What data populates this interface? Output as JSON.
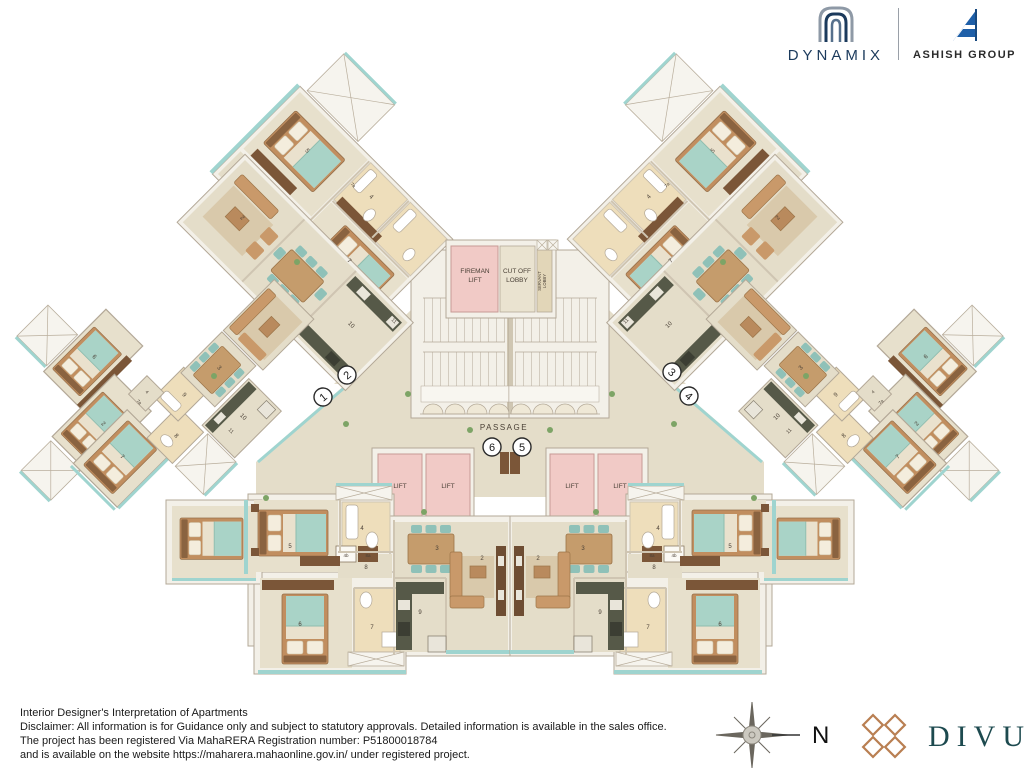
{
  "header": {
    "brand1": "DYNAMIX",
    "brand2": "ASHISH GROUP"
  },
  "footer": {
    "line1": "Interior Designer's Interpretation of Apartments",
    "line2": "Disclaimer: All information is for Guidance only and subject to statutory approvals. Detailed information is available in the sales office.",
    "line3": "The project has been registered Via MahaRERA Registration number:  P51800018784",
    "line4": "and is available on the website https://maharera.mahaonline.gov.in/ under registered project.",
    "compass_north": "N",
    "brand": "DIVUM"
  },
  "plan": {
    "colors": {
      "wall_line": "#b3a897",
      "floor": "#e4ddc9",
      "room_floor": "#e7e0cc",
      "bath_floor": "#eedebb",
      "lift_pink": "#f1cac6",
      "teal_edge": "#9fd4cf",
      "bed_blanket": "#a9d3c7",
      "wood": "#c59c6c",
      "dark_wood": "#6e4d33",
      "counter": "#565948",
      "navy": "#1b3a5c",
      "blue": "#1e5fa8",
      "copper": "#b97f52",
      "teal_dark": "#1d4a4f"
    },
    "labels": [
      {
        "t": "FIREMAN",
        "x": 475,
        "y": 273,
        "s": 6.5
      },
      {
        "t": "LIFT",
        "x": 475,
        "y": 282,
        "s": 6.5
      },
      {
        "t": "CUT OFF",
        "x": 517,
        "y": 273,
        "s": 6.5
      },
      {
        "t": "LOBBY",
        "x": 517,
        "y": 282,
        "s": 6.5
      },
      {
        "t": "SERVANT",
        "x": 541,
        "y": 281,
        "s": 4.2,
        "r": -90
      },
      {
        "t": "LOBBY",
        "x": 546,
        "y": 281,
        "s": 4.2,
        "r": -90
      },
      {
        "t": "PASSAGE",
        "x": 504,
        "y": 430,
        "s": 8,
        "ls": 1.5
      },
      {
        "t": "LIFT",
        "x": 400,
        "y": 488,
        "s": 6.5
      },
      {
        "t": "LIFT",
        "x": 448,
        "y": 488,
        "s": 6.5
      },
      {
        "t": "LIFT",
        "x": 572,
        "y": 488,
        "s": 6.5
      },
      {
        "t": "LIFT",
        "x": 620,
        "y": 488,
        "s": 6.5
      },
      {
        "t": "5",
        "x": 290,
        "y": 548,
        "s": 6
      },
      {
        "t": "4",
        "x": 362,
        "y": 530,
        "s": 6
      },
      {
        "t": "3",
        "x": 437,
        "y": 550,
        "s": 6
      },
      {
        "t": "8",
        "x": 366,
        "y": 569,
        "s": 6
      },
      {
        "t": "2",
        "x": 482,
        "y": 560,
        "s": 6
      },
      {
        "t": "6",
        "x": 300,
        "y": 626,
        "s": 6
      },
      {
        "t": "7",
        "x": 372,
        "y": 629,
        "s": 6
      },
      {
        "t": "9",
        "x": 420,
        "y": 614,
        "s": 6
      },
      {
        "t": "4b",
        "x": 346,
        "y": 557,
        "s": 4.5
      },
      {
        "t": "8a",
        "x": 368,
        "y": 557,
        "s": 4.5
      },
      {
        "t": "5",
        "x": 730,
        "y": 548,
        "s": 6
      },
      {
        "t": "4",
        "x": 658,
        "y": 530,
        "s": 6
      },
      {
        "t": "3",
        "x": 583,
        "y": 550,
        "s": 6
      },
      {
        "t": "8",
        "x": 654,
        "y": 569,
        "s": 6
      },
      {
        "t": "2",
        "x": 538,
        "y": 560,
        "s": 6
      },
      {
        "t": "6",
        "x": 720,
        "y": 626,
        "s": 6
      },
      {
        "t": "7",
        "x": 648,
        "y": 629,
        "s": 6
      },
      {
        "t": "9",
        "x": 600,
        "y": 614,
        "s": 6
      },
      {
        "t": "4b",
        "x": 674,
        "y": 557,
        "s": 4.5
      },
      {
        "t": "8a",
        "x": 652,
        "y": 557,
        "s": 4.5
      },
      {
        "t": "5",
        "x": 306,
        "y": 152,
        "s": 6,
        "r": 45
      },
      {
        "t": "4",
        "x": 370,
        "y": 198,
        "s": 6,
        "r": 45
      },
      {
        "t": "7a",
        "x": 352,
        "y": 186,
        "s": 4.5,
        "r": 45
      },
      {
        "t": "7",
        "x": 348,
        "y": 262,
        "s": 6,
        "r": 45
      },
      {
        "t": "5",
        "x": 714,
        "y": 152,
        "s": 6,
        "r": -45
      },
      {
        "t": "4",
        "x": 650,
        "y": 198,
        "s": 6,
        "r": -45
      },
      {
        "t": "7a",
        "x": 668,
        "y": 186,
        "s": 4.5,
        "r": -45
      },
      {
        "t": "7",
        "x": 672,
        "y": 262,
        "s": 6,
        "r": -45
      },
      {
        "t": "2",
        "x": 241,
        "y": 219,
        "s": 6,
        "r": 45
      },
      {
        "t": "10",
        "x": 350,
        "y": 326,
        "s": 6,
        "r": 45
      },
      {
        "t": "11",
        "x": 393,
        "y": 322,
        "s": 5,
        "r": 45
      },
      {
        "t": "2",
        "x": 779,
        "y": 219,
        "s": 6,
        "r": -45
      },
      {
        "t": "10",
        "x": 670,
        "y": 326,
        "s": 6,
        "r": -45
      },
      {
        "t": "11",
        "x": 627,
        "y": 322,
        "s": 5,
        "r": -45
      },
      {
        "t": "6",
        "x": 93,
        "y": 358,
        "s": 6,
        "r": 45
      },
      {
        "t": "2",
        "x": 102,
        "y": 425,
        "s": 6,
        "r": 45
      },
      {
        "t": "7",
        "x": 121,
        "y": 458,
        "s": 6,
        "r": 45
      },
      {
        "t": "8",
        "x": 175,
        "y": 437,
        "s": 6,
        "r": 45
      },
      {
        "t": "9",
        "x": 183,
        "y": 396,
        "s": 6,
        "r": 45
      },
      {
        "t": "4",
        "x": 146,
        "y": 393,
        "s": 4.5,
        "r": 45
      },
      {
        "t": "7a",
        "x": 138,
        "y": 403,
        "s": 4.5,
        "r": 45
      },
      {
        "t": "3",
        "x": 218,
        "y": 369,
        "s": 6,
        "r": 45
      },
      {
        "t": "10",
        "x": 242,
        "y": 418,
        "s": 6,
        "r": 45
      },
      {
        "t": "11",
        "x": 230,
        "y": 432,
        "s": 5,
        "r": 45
      },
      {
        "t": "6",
        "x": 927,
        "y": 358,
        "s": 6,
        "r": -45
      },
      {
        "t": "2",
        "x": 918,
        "y": 425,
        "s": 6,
        "r": -45
      },
      {
        "t": "7",
        "x": 899,
        "y": 458,
        "s": 6,
        "r": -45
      },
      {
        "t": "8",
        "x": 845,
        "y": 437,
        "s": 6,
        "r": -45
      },
      {
        "t": "9",
        "x": 837,
        "y": 396,
        "s": 6,
        "r": -45
      },
      {
        "t": "4",
        "x": 874,
        "y": 393,
        "s": 4.5,
        "r": -45
      },
      {
        "t": "7a",
        "x": 882,
        "y": 403,
        "s": 4.5,
        "r": -45
      },
      {
        "t": "3",
        "x": 802,
        "y": 369,
        "s": 6,
        "r": -45
      },
      {
        "t": "10",
        "x": 778,
        "y": 418,
        "s": 6,
        "r": -45
      },
      {
        "t": "11",
        "x": 790,
        "y": 432,
        "s": 5,
        "r": -45
      }
    ],
    "circles": [
      {
        "n": "1",
        "x": 323,
        "y": 397,
        "r": -40
      },
      {
        "n": "2",
        "x": 347,
        "y": 375,
        "r": -40
      },
      {
        "n": "3",
        "x": 672,
        "y": 372,
        "r": 40
      },
      {
        "n": "4",
        "x": 689,
        "y": 396,
        "r": 40
      },
      {
        "n": "5",
        "x": 522,
        "y": 447,
        "r": 0
      },
      {
        "n": "6",
        "x": 492,
        "y": 447,
        "r": 0
      }
    ]
  }
}
